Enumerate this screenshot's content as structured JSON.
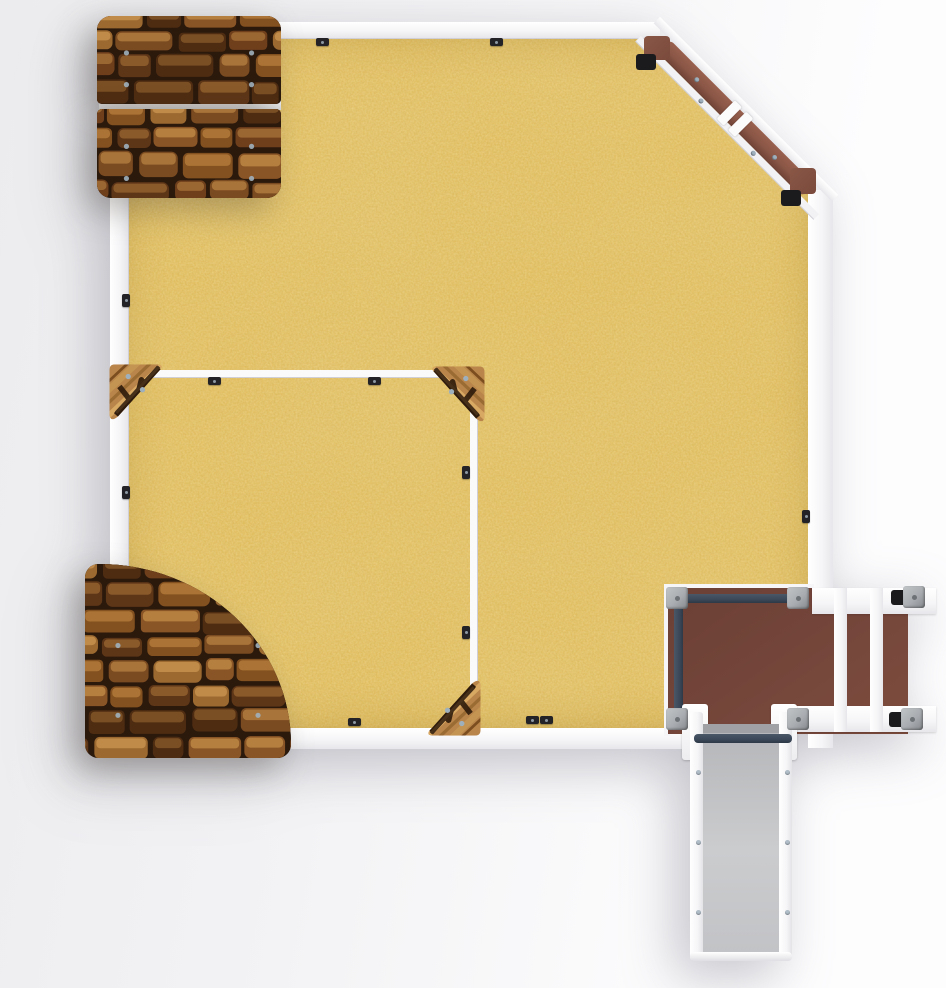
{
  "scene": {
    "description": "Top-down render of a square sandbox play unit with chamfered corner balance beam, inner toddler sandbox with wooden corner seats, two brick-textured climbing panels, a play deck with safety rails, an access step module and a slide",
    "regions": [
      "sandbox",
      "inner-sandbox",
      "brick-panel-top-left",
      "brick-panel-bottom-left",
      "corner-balance-beam",
      "play-deck",
      "access-steps",
      "slide",
      "wood-corner-seats"
    ]
  },
  "colors": {
    "sand": "#e2be5e",
    "frame": "#f5f5f7",
    "frame-shade": "#e7e7eb",
    "frame-edge": "#cfcfd5",
    "deck": "#73453a",
    "deck-light": "#7d4c3e",
    "navy": "#3b4859",
    "post": "#a9acb0",
    "cap": "#1b1b1e",
    "slide-bed-a": "#b4b5b8",
    "slide-bed-b": "#cbccce",
    "slide-lip": "#9fa1a4",
    "beam-plank": "#8a5646",
    "beam-block": "#7a4a3c",
    "wood-base": "#b9854a",
    "wood-dark": "#2e1b0b",
    "brick-bg": "#2b190c",
    "screw": "#9fb0bd",
    "clip": "#232327"
  },
  "brick_palette": [
    [
      "#6f3f1c",
      "#9a6631"
    ],
    [
      "#8a5526",
      "#b5803f"
    ],
    [
      "#5d3517",
      "#8a5a2a"
    ],
    [
      "#9c6a31",
      "#c08a49"
    ],
    [
      "#7a4a20",
      "#a87439"
    ],
    [
      "#4e2c12",
      "#7a4f24"
    ],
    [
      "#83501f",
      "#ab7436"
    ]
  ]
}
